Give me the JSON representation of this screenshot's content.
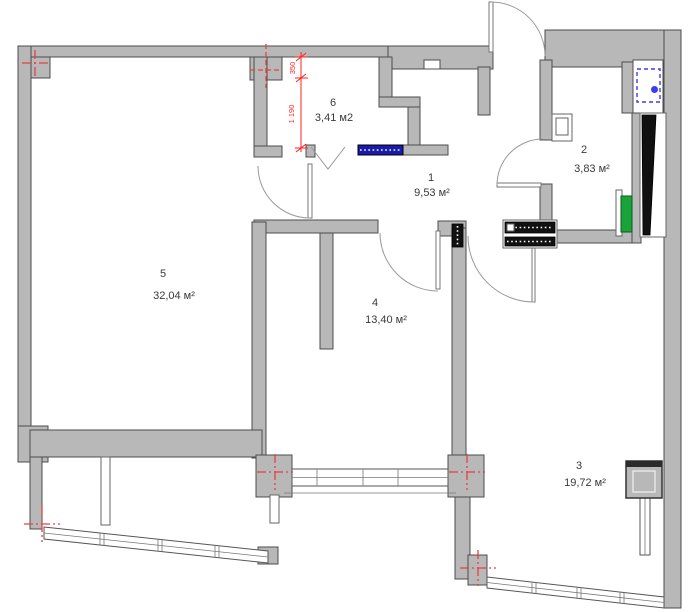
{
  "rooms": {
    "r1": {
      "number": "1",
      "area": "9,53 м²"
    },
    "r2": {
      "number": "2",
      "area": "3,83 м²"
    },
    "r3": {
      "number": "3",
      "area": "19,72 м²"
    },
    "r4": {
      "number": "4",
      "area": "13,40 м²"
    },
    "r5": {
      "number": "5",
      "area": "32,04 м²"
    },
    "r6": {
      "number": "6",
      "area": "3,41 м2"
    }
  },
  "dimensions": {
    "wall_offset": "350",
    "opening_width": "1 190"
  },
  "icons": {
    "washing_machine": "washing-machine-icon",
    "radiator": "radiator",
    "vent_shaft": "vent-shaft",
    "vent_duct": "vent-duct",
    "axis_marker": "axis-cross"
  },
  "colors": {
    "wall_fill": "#b8b8b8",
    "wall_stroke": "#4d4d4d",
    "axis_red": "#e84040",
    "dimension_red": "#ff2020",
    "fixture_blue": "#3c3cf0",
    "lintel_blue": "#1a1aad",
    "radiator_green": "#19a338",
    "shaft_black": "#111111",
    "background": "#ffffff",
    "label_text": "#3a3a3a"
  }
}
